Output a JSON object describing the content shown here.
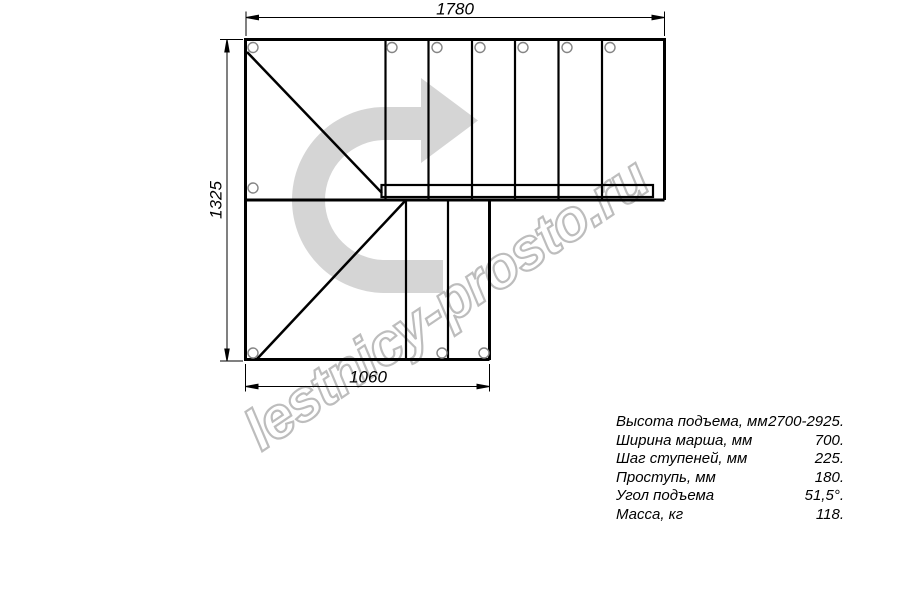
{
  "dimensions": {
    "top": "1780",
    "left": "1325",
    "bottom": "1060"
  },
  "watermark": {
    "text": "lestnicy-prosto.ru"
  },
  "specs": {
    "rows": [
      {
        "label": "Высота подъема, мм",
        "value": "2700-2925."
      },
      {
        "label": "Ширина марша, мм",
        "value": "700."
      },
      {
        "label": "Шаг ступеней, мм",
        "value": "225."
      },
      {
        "label": "Проступь, мм",
        "value": "180."
      },
      {
        "label": "Угол подъема",
        "value": "51,5°."
      },
      {
        "label": "Масса, кг",
        "value": "118."
      }
    ]
  },
  "colors": {
    "background": "#ffffff",
    "line": "#000000",
    "circle_outline": "#858585",
    "arrow_fill": "#d5d5d5",
    "watermark_outline": "#bdbdbd"
  }
}
